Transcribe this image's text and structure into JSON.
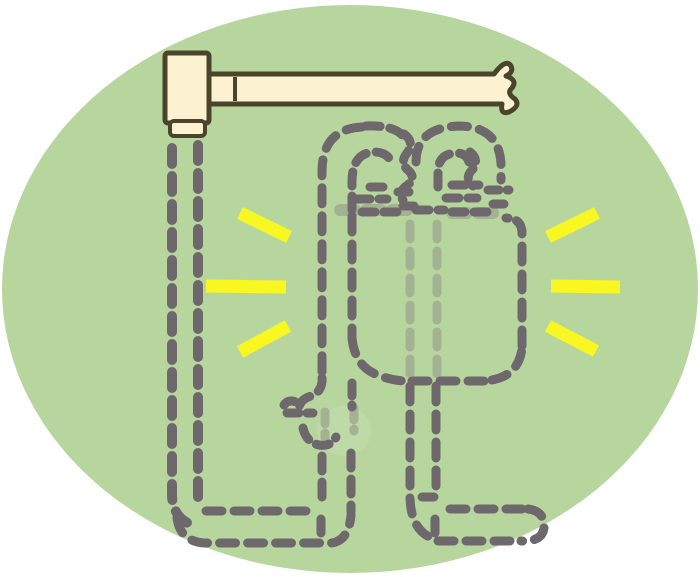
{
  "meta": {
    "description": "Clipart illustration of an invisible figure drawn with gray dashed outlines inside a green ellipse; it hangs below a cream wooden mallet/bar whose handle is torn off at the right; lighter green-gray dashes show parts seen through the transparent body; yellow sparkle lines radiate on both sides.",
    "canvas": {
      "width": 700,
      "height": 577
    }
  },
  "palette": {
    "page_bg": "#ffffff",
    "ellipse_green": "#b7d69e",
    "dash_dark": "#6e676c",
    "dash_light": "#a4b294",
    "spark_yellow": "#f8f721",
    "wood_cream": "#fcf2d2",
    "outline_olive": "#4a442a",
    "hand_glow": "#c5dfaf"
  },
  "layers": [
    {
      "name": "background-ellipse",
      "shapes": [
        {
          "tag": "ellipse",
          "name": "green-ellipse",
          "attrs": {
            "cx": 350,
            "cy": 289,
            "rx": 348,
            "ry": 284,
            "fill": "$ellipse_green"
          }
        }
      ]
    },
    {
      "name": "mallet",
      "shapes": [
        {
          "tag": "path",
          "name": "mallet-handle",
          "attrs": {
            "d": "M206,74 H494 Q506,58 511,66 Q514,72 506,76 Q518,80 512,88 Q506,93 515,99 Q521,106 509,112 Q500,115 502,104 H206 Z",
            "fill": "$wood_cream",
            "stroke": "$outline_olive",
            "stroke-width": 5,
            "stroke-linejoin": "round"
          }
        },
        {
          "tag": "rect",
          "name": "mallet-head",
          "attrs": {
            "x": 165,
            "y": 53,
            "width": 44,
            "height": 70,
            "rx": 3,
            "fill": "$wood_cream",
            "stroke": "$outline_olive",
            "stroke-width": 5,
            "stroke-linejoin": "round"
          }
        },
        {
          "tag": "rect",
          "name": "mallet-cap",
          "attrs": {
            "x": 170,
            "y": 121,
            "width": 35,
            "height": 15,
            "rx": 4,
            "fill": "$wood_cream",
            "stroke": "$outline_olive",
            "stroke-width": 4,
            "stroke-linejoin": "round"
          }
        },
        {
          "tag": "path",
          "name": "mallet-handle-joint",
          "attrs": {
            "d": "M235,77 V101",
            "fill": "none",
            "stroke": "$outline_olive",
            "stroke-width": 4
          }
        }
      ]
    },
    {
      "name": "see-through-glow",
      "shapes": [
        {
          "tag": "ellipse",
          "name": "hand-glow-blob",
          "attrs": {
            "cx": 344,
            "cy": 431,
            "rx": 27,
            "ry": 25,
            "fill": "$hand_glow",
            "opacity": 0.55
          }
        }
      ]
    },
    {
      "name": "see-through-strokes",
      "shapes": [
        {
          "tag": "path",
          "name": "bar-through-left-hand",
          "attrs": {
            "d": "M340,210 H412",
            "fill": "none",
            "stroke": "$dash_light",
            "stroke-width": 12,
            "stroke-linecap": "round",
            "stroke-dasharray": "15 11"
          }
        },
        {
          "tag": "path",
          "name": "bar-through-right-hand",
          "attrs": {
            "d": "M452,213 H502",
            "fill": "none",
            "stroke": "$dash_light",
            "stroke-width": 12,
            "stroke-linecap": "round",
            "stroke-dasharray": "15 11"
          }
        },
        {
          "tag": "path",
          "name": "through-line-a",
          "attrs": {
            "d": "M410,224 V374",
            "fill": "none",
            "stroke": "$dash_light",
            "stroke-width": 9,
            "stroke-linecap": "round",
            "stroke-dasharray": "15 12"
          }
        },
        {
          "tag": "path",
          "name": "through-line-b",
          "attrs": {
            "d": "M437,224 V374",
            "fill": "none",
            "stroke": "$dash_light",
            "stroke-width": 9,
            "stroke-linecap": "round",
            "stroke-dasharray": "15 12"
          }
        },
        {
          "tag": "path",
          "name": "hand-through-a",
          "attrs": {
            "d": "M325,412 V438",
            "fill": "none",
            "stroke": "$dash_light",
            "stroke-width": 9,
            "stroke-linecap": "round",
            "stroke-dasharray": "12 9"
          }
        },
        {
          "tag": "path",
          "name": "hand-through-b",
          "attrs": {
            "d": "M354,408 V431",
            "fill": "none",
            "stroke": "$dash_light",
            "stroke-width": 9,
            "stroke-linecap": "round",
            "stroke-dasharray": "12 9"
          }
        }
      ]
    },
    {
      "name": "invisible-figure-strokes",
      "shapes": [
        {
          "tag": "path",
          "name": "pole-outer-line",
          "attrs": {
            "d": "M172,148 V494 Q172,519 195,526",
            "fill": "none",
            "stroke": "$dash_dark",
            "stroke-width": 10,
            "stroke-linecap": "round",
            "stroke-dasharray": "16 12"
          }
        },
        {
          "tag": "path",
          "name": "pole-inner-line",
          "attrs": {
            "d": "M198,145 V506",
            "fill": "none",
            "stroke": "$dash_dark",
            "stroke-width": 10,
            "stroke-linecap": "round",
            "stroke-dasharray": "16 12"
          }
        },
        {
          "tag": "path",
          "name": "left-shoe-top",
          "attrs": {
            "d": "M206,511 H312",
            "fill": "none",
            "stroke": "$dash_dark",
            "stroke-width": 9,
            "stroke-linecap": "round",
            "stroke-dasharray": "16 12"
          }
        },
        {
          "tag": "path",
          "name": "left-shoe-bottom",
          "attrs": {
            "d": "M177,518 Q180,541 204,543 H332 Q349,540 351,515",
            "fill": "none",
            "stroke": "$dash_dark",
            "stroke-width": 9,
            "stroke-linecap": "round",
            "stroke-dasharray": "16 12"
          }
        },
        {
          "tag": "path",
          "name": "left-shoe-heel",
          "attrs": {
            "d": "M321,519 V540",
            "fill": "none",
            "stroke": "$dash_dark",
            "stroke-width": 9,
            "stroke-linecap": "round",
            "stroke-dasharray": "14 10"
          }
        },
        {
          "tag": "path",
          "name": "left-ankle-inner",
          "attrs": {
            "d": "M322,456 V507",
            "fill": "none",
            "stroke": "$dash_dark",
            "stroke-width": 9,
            "stroke-linecap": "round",
            "stroke-dasharray": "15 11"
          }
        },
        {
          "tag": "path",
          "name": "left-ankle-outer",
          "attrs": {
            "d": "M351,453 V512",
            "fill": "none",
            "stroke": "$dash_dark",
            "stroke-width": 9,
            "stroke-linecap": "round",
            "stroke-dasharray": "15 11"
          }
        },
        {
          "tag": "path",
          "name": "left-arm-outer",
          "attrs": {
            "d": "M362,127 Q323,129 322,170 V378",
            "fill": "none",
            "stroke": "$dash_dark",
            "stroke-width": 9,
            "stroke-linecap": "round",
            "stroke-dasharray": "16 12"
          }
        },
        {
          "tag": "path",
          "name": "left-arm-jog-to-hand",
          "attrs": {
            "d": "M322,378 Q323,391 311,396 Q299,400 299,409",
            "fill": "none",
            "stroke": "$dash_dark",
            "stroke-width": 9,
            "stroke-linecap": "round",
            "stroke-dasharray": "14 10"
          }
        },
        {
          "tag": "path",
          "name": "left-arch-top-right",
          "attrs": {
            "d": "M366,126 Q395,125 404,137",
            "fill": "none",
            "stroke": "$dash_dark",
            "stroke-width": 9,
            "stroke-linecap": "round",
            "stroke-dasharray": "14 10"
          }
        },
        {
          "tag": "path",
          "name": "left-profile-wiggle",
          "attrs": {
            "d": "M404,134 Q415,142 407,153 Q399,163 409,171 Q417,179 405,187 Q398,193 403,200",
            "fill": "none",
            "stroke": "$dash_dark",
            "stroke-width": 9,
            "stroke-linecap": "round",
            "stroke-dasharray": "11 8"
          }
        },
        {
          "tag": "path",
          "name": "left-arch-inner",
          "attrs": {
            "d": "M352,210 V182 Q352,153 374,152 Q389,152 392,165",
            "fill": "none",
            "stroke": "$dash_dark",
            "stroke-width": 9,
            "stroke-linecap": "round",
            "stroke-dasharray": "14 10"
          }
        },
        {
          "tag": "path",
          "name": "left-fist-rows",
          "attrs": {
            "d": "M370,187 H391 M357,199 H387 M362,212 H401",
            "fill": "none",
            "stroke": "$dash_dark",
            "stroke-width": 9,
            "stroke-linecap": "round",
            "stroke-dasharray": "13 9"
          }
        },
        {
          "tag": "path",
          "name": "left-fist-side-bits",
          "attrs": {
            "d": "M398,192 H413 M403,206 H417",
            "fill": "none",
            "stroke": "$dash_dark",
            "stroke-width": 9,
            "stroke-linecap": "round",
            "stroke-dasharray": "11 8"
          }
        },
        {
          "tag": "path",
          "name": "right-arch-outer",
          "attrs": {
            "d": "M416,162 Q416,128 458,126 Q499,126 501,164 V180",
            "fill": "none",
            "stroke": "$dash_dark",
            "stroke-width": 9,
            "stroke-linecap": "round",
            "stroke-dasharray": "16 12"
          }
        },
        {
          "tag": "path",
          "name": "right-arch-inner",
          "attrs": {
            "d": "M438,187 V172 Q438,154 456,153 Q469,153 470,167",
            "fill": "none",
            "stroke": "$dash_dark",
            "stroke-width": 9,
            "stroke-linecap": "round",
            "stroke-dasharray": "14 10"
          }
        },
        {
          "tag": "path",
          "name": "right-profile-wiggle",
          "attrs": {
            "d": "M470,152 Q480,160 472,170 Q464,178 473,186",
            "fill": "none",
            "stroke": "$dash_dark",
            "stroke-width": 9,
            "stroke-linecap": "round",
            "stroke-dasharray": "11 8"
          }
        },
        {
          "tag": "path",
          "name": "right-fist-rows",
          "attrs": {
            "d": "M452,185 H479 M446,198 H477 M452,212 H495",
            "fill": "none",
            "stroke": "$dash_dark",
            "stroke-width": 9,
            "stroke-linecap": "round",
            "stroke-dasharray": "13 9"
          }
        },
        {
          "tag": "path",
          "name": "right-fist-side-bits",
          "attrs": {
            "d": "M488,190 H509 M493,204 H512",
            "fill": "none",
            "stroke": "$dash_dark",
            "stroke-width": 9,
            "stroke-linecap": "round",
            "stroke-dasharray": "11 8"
          }
        },
        {
          "tag": "path",
          "name": "between-fists-dash",
          "attrs": {
            "d": "M416,210 H444",
            "fill": "none",
            "stroke": "$dash_dark",
            "stroke-width": 9,
            "stroke-linecap": "round",
            "stroke-dasharray": "13 9"
          }
        },
        {
          "tag": "path",
          "name": "torso-left-edge",
          "attrs": {
            "d": "M352,216 V338",
            "fill": "none",
            "stroke": "$dash_dark",
            "stroke-width": 9,
            "stroke-linecap": "round",
            "stroke-dasharray": "16 12"
          }
        },
        {
          "tag": "path",
          "name": "torso-bottom-left-corner",
          "attrs": {
            "d": "M352,338 Q355,367 378,375 Q392,381 408,381",
            "fill": "none",
            "stroke": "$dash_dark",
            "stroke-width": 9,
            "stroke-linecap": "round",
            "stroke-dasharray": "16 12"
          }
        },
        {
          "tag": "path",
          "name": "torso-bottom-edge",
          "attrs": {
            "d": "M412,381 H490",
            "fill": "none",
            "stroke": "$dash_dark",
            "stroke-width": 9,
            "stroke-linecap": "round",
            "stroke-dasharray": "16 12"
          }
        },
        {
          "tag": "path",
          "name": "torso-bottom-right-corner",
          "attrs": {
            "d": "M492,380 Q519,375 522,348",
            "fill": "none",
            "stroke": "$dash_dark",
            "stroke-width": 9,
            "stroke-linecap": "round",
            "stroke-dasharray": "16 12"
          }
        },
        {
          "tag": "path",
          "name": "torso-right-edge",
          "attrs": {
            "d": "M522,346 V232",
            "fill": "none",
            "stroke": "$dash_dark",
            "stroke-width": 9,
            "stroke-linecap": "round",
            "stroke-dasharray": "16 12"
          }
        },
        {
          "tag": "path",
          "name": "torso-top-right-corner",
          "attrs": {
            "d": "M522,232 Q521,218 506,218",
            "fill": "none",
            "stroke": "$dash_dark",
            "stroke-width": 9,
            "stroke-linecap": "round",
            "stroke-dasharray": "13 9"
          }
        },
        {
          "tag": "path",
          "name": "hand-thumb-dashes",
          "attrs": {
            "d": "M284,405 Q288,399 296,402 M287,413 H313",
            "fill": "none",
            "stroke": "$dash_dark",
            "stroke-width": 9,
            "stroke-linecap": "round",
            "stroke-dasharray": "12 8"
          }
        },
        {
          "tag": "path",
          "name": "hand-curl",
          "attrs": {
            "d": "M303,428 Q306,442 319,445 Q331,447 336,437",
            "fill": "none",
            "stroke": "$dash_dark",
            "stroke-width": 9,
            "stroke-linecap": "round",
            "stroke-dasharray": "13 9"
          }
        },
        {
          "tag": "path",
          "name": "hand-inner-stub",
          "attrs": {
            "d": "M352,383 V407",
            "fill": "none",
            "stroke": "$dash_dark",
            "stroke-width": 9,
            "stroke-linecap": "round",
            "stroke-dasharray": "13 9"
          }
        },
        {
          "tag": "path",
          "name": "right-leg-left-line",
          "attrs": {
            "d": "M410,386 V498 Q411,531 434,539",
            "fill": "none",
            "stroke": "$dash_dark",
            "stroke-width": 9,
            "stroke-linecap": "round",
            "stroke-dasharray": "16 12"
          }
        },
        {
          "tag": "path",
          "name": "right-leg-right-line",
          "attrs": {
            "d": "M436,386 V489",
            "fill": "none",
            "stroke": "$dash_dark",
            "stroke-width": 9,
            "stroke-linecap": "round",
            "stroke-dasharray": "16 12"
          }
        },
        {
          "tag": "path",
          "name": "right-ankle-dash",
          "attrs": {
            "d": "M422,497 H438",
            "fill": "none",
            "stroke": "$dash_dark",
            "stroke-width": 9,
            "stroke-linecap": "round",
            "stroke-dasharray": "12 8"
          }
        },
        {
          "tag": "path",
          "name": "right-shoe-top",
          "attrs": {
            "d": "M450,509 H526",
            "fill": "none",
            "stroke": "$dash_dark",
            "stroke-width": 9,
            "stroke-linecap": "round",
            "stroke-dasharray": "16 12"
          }
        },
        {
          "tag": "path",
          "name": "right-shoe-toe",
          "attrs": {
            "d": "M528,509 Q545,511 544,528 Q542,542 521,541",
            "fill": "none",
            "stroke": "$dash_dark",
            "stroke-width": 9,
            "stroke-linecap": "round",
            "stroke-dasharray": "16 12"
          }
        },
        {
          "tag": "path",
          "name": "right-shoe-bottom",
          "attrs": {
            "d": "M438,541 H518",
            "fill": "none",
            "stroke": "$dash_dark",
            "stroke-width": 9,
            "stroke-linecap": "round",
            "stroke-dasharray": "16 12"
          }
        },
        {
          "tag": "path",
          "name": "right-shoe-heel",
          "attrs": {
            "d": "M435,519 V539",
            "fill": "none",
            "stroke": "$dash_dark",
            "stroke-width": 9,
            "stroke-linecap": "round",
            "stroke-dasharray": "14 10"
          }
        }
      ]
    },
    {
      "name": "sparkle-lines",
      "shapes": [
        {
          "tag": "line",
          "name": "sparkle-left-top",
          "attrs": {
            "x1": 240,
            "y1": 213,
            "x2": 289,
            "y2": 237,
            "stroke": "$spark_yellow",
            "stroke-width": 13,
            "stroke-linecap": "butt"
          }
        },
        {
          "tag": "line",
          "name": "sparkle-left-middle",
          "attrs": {
            "x1": 206,
            "y1": 286,
            "x2": 286,
            "y2": 287,
            "stroke": "$spark_yellow",
            "stroke-width": 13,
            "stroke-linecap": "butt"
          }
        },
        {
          "tag": "line",
          "name": "sparkle-left-bottom",
          "attrs": {
            "x1": 240,
            "y1": 352,
            "x2": 288,
            "y2": 326,
            "stroke": "$spark_yellow",
            "stroke-width": 13,
            "stroke-linecap": "butt"
          }
        },
        {
          "tag": "line",
          "name": "sparkle-right-top",
          "attrs": {
            "x1": 548,
            "y1": 237,
            "x2": 597,
            "y2": 213,
            "stroke": "$spark_yellow",
            "stroke-width": 13,
            "stroke-linecap": "butt"
          }
        },
        {
          "tag": "line",
          "name": "sparkle-right-middle",
          "attrs": {
            "x1": 551,
            "y1": 286,
            "x2": 620,
            "y2": 287,
            "stroke": "$spark_yellow",
            "stroke-width": 13,
            "stroke-linecap": "butt"
          }
        },
        {
          "tag": "line",
          "name": "sparkle-right-bottom",
          "attrs": {
            "x1": 548,
            "y1": 326,
            "x2": 596,
            "y2": 351,
            "stroke": "$spark_yellow",
            "stroke-width": 13,
            "stroke-linecap": "butt"
          }
        }
      ]
    }
  ]
}
